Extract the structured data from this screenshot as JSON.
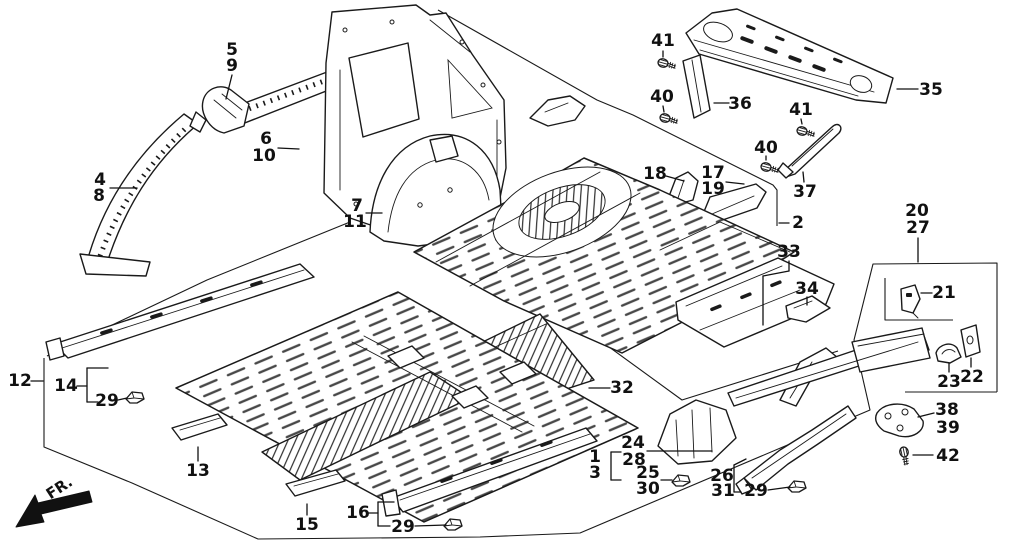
{
  "diagram": {
    "type": "exploded-parts-diagram",
    "subject": "vehicle body inner panels and floor group",
    "orientation_label": "FR.",
    "ink_color": "#1a1a1a",
    "background_color": "#ffffff"
  },
  "callouts": [
    {
      "id": "5-9",
      "labels": [
        {
          "t": "5",
          "x": 232,
          "y": 50
        },
        {
          "t": "9",
          "x": 232,
          "y": 66
        }
      ],
      "leaders": [
        [
          232,
          75,
          226,
          99
        ]
      ]
    },
    {
      "id": "6-10",
      "labels": [
        {
          "t": "6",
          "x": 266,
          "y": 139
        },
        {
          "t": "10",
          "x": 264,
          "y": 156
        }
      ],
      "leaders": [
        [
          278,
          148,
          299,
          149
        ]
      ]
    },
    {
      "id": "4-8",
      "labels": [
        {
          "t": "4",
          "x": 100,
          "y": 180
        },
        {
          "t": "8",
          "x": 99,
          "y": 196
        }
      ],
      "leaders": [
        [
          110,
          188,
          137,
          188
        ]
      ]
    },
    {
      "id": "7-11",
      "labels": [
        {
          "t": "7",
          "x": 357,
          "y": 206
        },
        {
          "t": "11",
          "x": 355,
          "y": 222
        }
      ],
      "leaders": [
        [
          366,
          213,
          382,
          213
        ]
      ]
    },
    {
      "id": "41a",
      "labels": [
        {
          "t": "41",
          "x": 663,
          "y": 41
        }
      ],
      "leaders": [
        [
          663,
          51,
          663,
          57
        ]
      ]
    },
    {
      "id": "40a",
      "labels": [
        {
          "t": "40",
          "x": 662,
          "y": 97
        }
      ],
      "leaders": [
        [
          663,
          106,
          664,
          112
        ]
      ]
    },
    {
      "id": "36",
      "labels": [
        {
          "t": "36",
          "x": 740,
          "y": 104
        }
      ],
      "leaders": [
        [
          714,
          103,
          729,
          103
        ]
      ]
    },
    {
      "id": "35",
      "labels": [
        {
          "t": "35",
          "x": 931,
          "y": 90
        }
      ],
      "leaders": [
        [
          897,
          89,
          918,
          89
        ]
      ]
    },
    {
      "id": "41b",
      "labels": [
        {
          "t": "41",
          "x": 801,
          "y": 110
        }
      ],
      "leaders": [
        [
          801,
          119,
          802,
          124
        ]
      ]
    },
    {
      "id": "40b",
      "labels": [
        {
          "t": "40",
          "x": 766,
          "y": 148
        }
      ],
      "leaders": [
        [
          766,
          156,
          766,
          160
        ]
      ]
    },
    {
      "id": "37",
      "labels": [
        {
          "t": "37",
          "x": 805,
          "y": 192
        }
      ],
      "leaders": [
        [
          803,
          172,
          804,
          182
        ]
      ]
    },
    {
      "id": "18",
      "labels": [
        {
          "t": "18",
          "x": 655,
          "y": 174
        }
      ],
      "leaders": [
        [
          666,
          176,
          684,
          181
        ]
      ]
    },
    {
      "id": "17-19",
      "labels": [
        {
          "t": "17",
          "x": 713,
          "y": 173
        },
        {
          "t": "19",
          "x": 713,
          "y": 189
        }
      ],
      "leaders": [
        [
          726,
          182,
          744,
          184
        ]
      ]
    },
    {
      "id": "2",
      "labels": [
        {
          "t": "2",
          "x": 798,
          "y": 223
        }
      ],
      "leaders": [
        [
          779,
          223,
          789,
          223
        ]
      ]
    },
    {
      "id": "33",
      "labels": [
        {
          "t": "33",
          "x": 789,
          "y": 252
        }
      ],
      "leaders": [
        [
          789,
          261,
          789,
          271
        ],
        [
          789,
          271,
          763,
          276
        ],
        [
          763,
          276,
          763,
          325
        ]
      ]
    },
    {
      "id": "34",
      "labels": [
        {
          "t": "34",
          "x": 807,
          "y": 289
        }
      ],
      "leaders": [
        [
          807,
          297,
          807,
          305
        ]
      ]
    },
    {
      "id": "20-27",
      "labels": [
        {
          "t": "20",
          "x": 917,
          "y": 211
        },
        {
          "t": "27",
          "x": 918,
          "y": 228
        }
      ],
      "leaders": [
        [
          918,
          238,
          918,
          262
        ]
      ]
    },
    {
      "id": "21",
      "labels": [
        {
          "t": "21",
          "x": 944,
          "y": 293
        }
      ],
      "leaders": [
        [
          921,
          293,
          932,
          293
        ]
      ]
    },
    {
      "id": "23",
      "labels": [
        {
          "t": "23",
          "x": 949,
          "y": 382
        }
      ],
      "leaders": [
        [
          949,
          363,
          949,
          372
        ]
      ]
    },
    {
      "id": "22",
      "labels": [
        {
          "t": "22",
          "x": 972,
          "y": 377
        }
      ],
      "leaders": [
        [
          971,
          358,
          971,
          367
        ]
      ]
    },
    {
      "id": "38-39",
      "labels": [
        {
          "t": "38",
          "x": 947,
          "y": 410
        },
        {
          "t": "39",
          "x": 948,
          "y": 428
        }
      ],
      "leaders": [
        [
          918,
          417,
          934,
          413
        ]
      ]
    },
    {
      "id": "42",
      "labels": [
        {
          "t": "42",
          "x": 948,
          "y": 456
        }
      ],
      "leaders": [
        [
          913,
          455,
          933,
          455
        ]
      ]
    },
    {
      "id": "12",
      "labels": [
        {
          "t": "12",
          "x": 20,
          "y": 381
        }
      ],
      "leaders": [
        [
          31,
          381,
          43,
          381
        ]
      ]
    },
    {
      "id": "14",
      "labels": [
        {
          "t": "14",
          "x": 66,
          "y": 386
        }
      ],
      "leaders": [
        [
          77,
          386,
          87,
          386
        ],
        [
          87,
          368,
          87,
          402
        ],
        [
          87,
          368,
          108,
          368
        ],
        [
          87,
          402,
          98,
          402
        ]
      ]
    },
    {
      "id": "29a",
      "labels": [
        {
          "t": "29",
          "x": 107,
          "y": 401
        }
      ],
      "leaders": [
        [
          118,
          400,
          127,
          398
        ]
      ]
    },
    {
      "id": "13",
      "labels": [
        {
          "t": "13",
          "x": 198,
          "y": 471
        }
      ],
      "leaders": [
        [
          198,
          447,
          198,
          461
        ]
      ]
    },
    {
      "id": "15",
      "labels": [
        {
          "t": "15",
          "x": 307,
          "y": 525
        }
      ],
      "leaders": [
        [
          307,
          504,
          307,
          515
        ]
      ]
    },
    {
      "id": "16",
      "labels": [
        {
          "t": "16",
          "x": 358,
          "y": 513
        }
      ],
      "leaders": [
        [
          369,
          513,
          378,
          513
        ],
        [
          378,
          502,
          378,
          526
        ],
        [
          378,
          502,
          394,
          502
        ],
        [
          378,
          526,
          390,
          526
        ]
      ]
    },
    {
      "id": "29b",
      "labels": [
        {
          "t": "29",
          "x": 403,
          "y": 527
        }
      ],
      "leaders": [
        [
          415,
          526,
          446,
          525
        ]
      ]
    },
    {
      "id": "1-3",
      "labels": [
        {
          "t": "1",
          "x": 595,
          "y": 457
        },
        {
          "t": "3",
          "x": 595,
          "y": 473
        }
      ],
      "leaders": [
        [
          611,
          452,
          611,
          480
        ],
        [
          611,
          452,
          621,
          452
        ],
        [
          611,
          480,
          621,
          480
        ]
      ]
    },
    {
      "id": "24-28",
      "labels": [
        {
          "t": "24",
          "x": 633,
          "y": 443
        },
        {
          "t": "28",
          "x": 634,
          "y": 460
        }
      ],
      "leaders": [
        [
          647,
          451,
          712,
          451
        ]
      ]
    },
    {
      "id": "25-30",
      "labels": [
        {
          "t": "25",
          "x": 648,
          "y": 473
        },
        {
          "t": "30",
          "x": 648,
          "y": 489
        }
      ],
      "leaders": [
        [
          661,
          480,
          672,
          480
        ]
      ]
    },
    {
      "id": "26-31",
      "labels": [
        {
          "t": "26",
          "x": 722,
          "y": 476
        },
        {
          "t": "31",
          "x": 723,
          "y": 491
        }
      ],
      "leaders": [
        [
          734,
          465,
          734,
          492
        ],
        [
          734,
          465,
          746,
          459
        ],
        [
          734,
          492,
          741,
          492
        ]
      ]
    },
    {
      "id": "29c",
      "labels": [
        {
          "t": "29",
          "x": 756,
          "y": 491
        }
      ],
      "leaders": [
        [
          768,
          490,
          790,
          487
        ]
      ]
    },
    {
      "id": "32",
      "labels": [
        {
          "t": "32",
          "x": 622,
          "y": 388
        }
      ],
      "leaders": [
        [
          589,
          388,
          610,
          388
        ]
      ]
    }
  ],
  "hardware": {
    "bolts": [
      {
        "x": 663,
        "y": 63,
        "rot": 15
      },
      {
        "x": 665,
        "y": 118,
        "rot": 15
      },
      {
        "x": 802,
        "y": 131,
        "rot": 15
      },
      {
        "x": 766,
        "y": 167,
        "rot": 15
      },
      {
        "x": 904,
        "y": 452,
        "rot": 78
      }
    ],
    "clips": [
      {
        "x": 135,
        "y": 397
      },
      {
        "x": 453,
        "y": 524
      },
      {
        "x": 681,
        "y": 480
      },
      {
        "x": 797,
        "y": 486
      }
    ]
  }
}
